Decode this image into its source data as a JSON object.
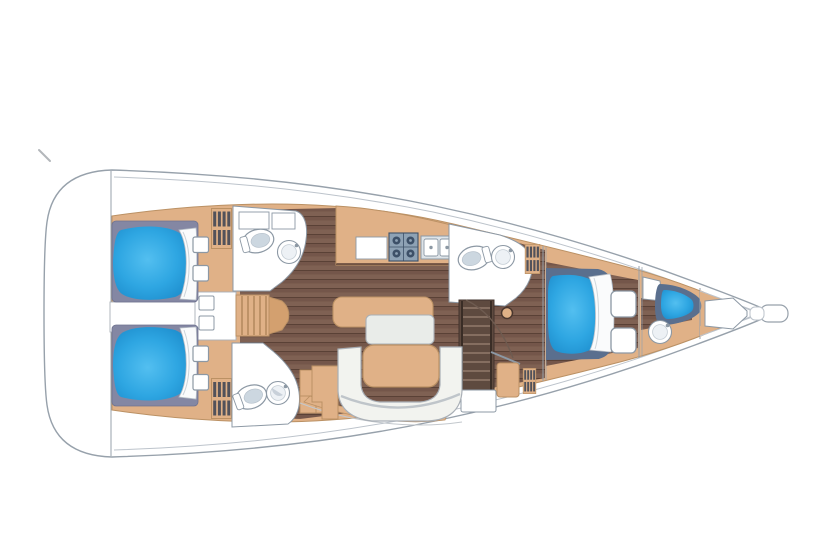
{
  "page": {
    "title": "Sailing yacht interior deck plan",
    "type": "yacht-interior-floorplan",
    "orientation": "bow-right-stern-left"
  },
  "colors": {
    "white": "#ffffff",
    "hullStroke": "#97a1ab",
    "toeRail": "#bcc3cb",
    "tan": "#e0b187",
    "tanStroke": "#bb9164",
    "tanDark": "#d3a06f",
    "stepLine": "#a87d52",
    "floorBase": "#74564a",
    "floorLight": "#836455",
    "floorDark": "#5a4136",
    "berthBaseAft": "#8487a3",
    "berthBaseFwd": "#5a6f8e",
    "blueLight": "#53bff0",
    "blueMid": "#2ea6e2",
    "blueDeep": "#1b8aca",
    "fixtureStroke": "#8c98a4",
    "porcelain": "#edf1f5",
    "headInner": "#ccd7e0",
    "sinkShade": "#b3bfc9",
    "stoveFill": "#8ea2b5",
    "stoveDark": "#3d5068",
    "setteeFill": "#f2f3ef",
    "setteeStroke": "#a9afb6",
    "leafFill": "#e9ece9",
    "lockerStripe": "#3f4554",
    "stairsWood": "#5e4a3f",
    "stairsTread": "#8b7366",
    "seam": "#c3c8cd",
    "pillow": "#fafbfc",
    "mark": "#b3b7bb"
  },
  "legend": {
    "compartments": [
      "transom-swim-platform",
      "aft-cabin-port-double-berth",
      "aft-cabin-starboard-double-berth",
      "aft-head-port",
      "aft-head-starboard",
      "companionway-steps",
      "galley",
      "salon-u-settee-and-table",
      "mid-head",
      "stair-nav-area",
      "forward-owner-cabin-island-berth",
      "bow-crew-cabin",
      "anchor-locker",
      "bow-roller"
    ],
    "fixtures": [
      "toilet",
      "round-sink",
      "double-galley-sink",
      "stove-4-burner",
      "fridge-counter",
      "mast-post",
      "louvered-locker",
      "deck-hatch",
      "chart-table",
      "berth-mattress",
      "pillow"
    ]
  }
}
